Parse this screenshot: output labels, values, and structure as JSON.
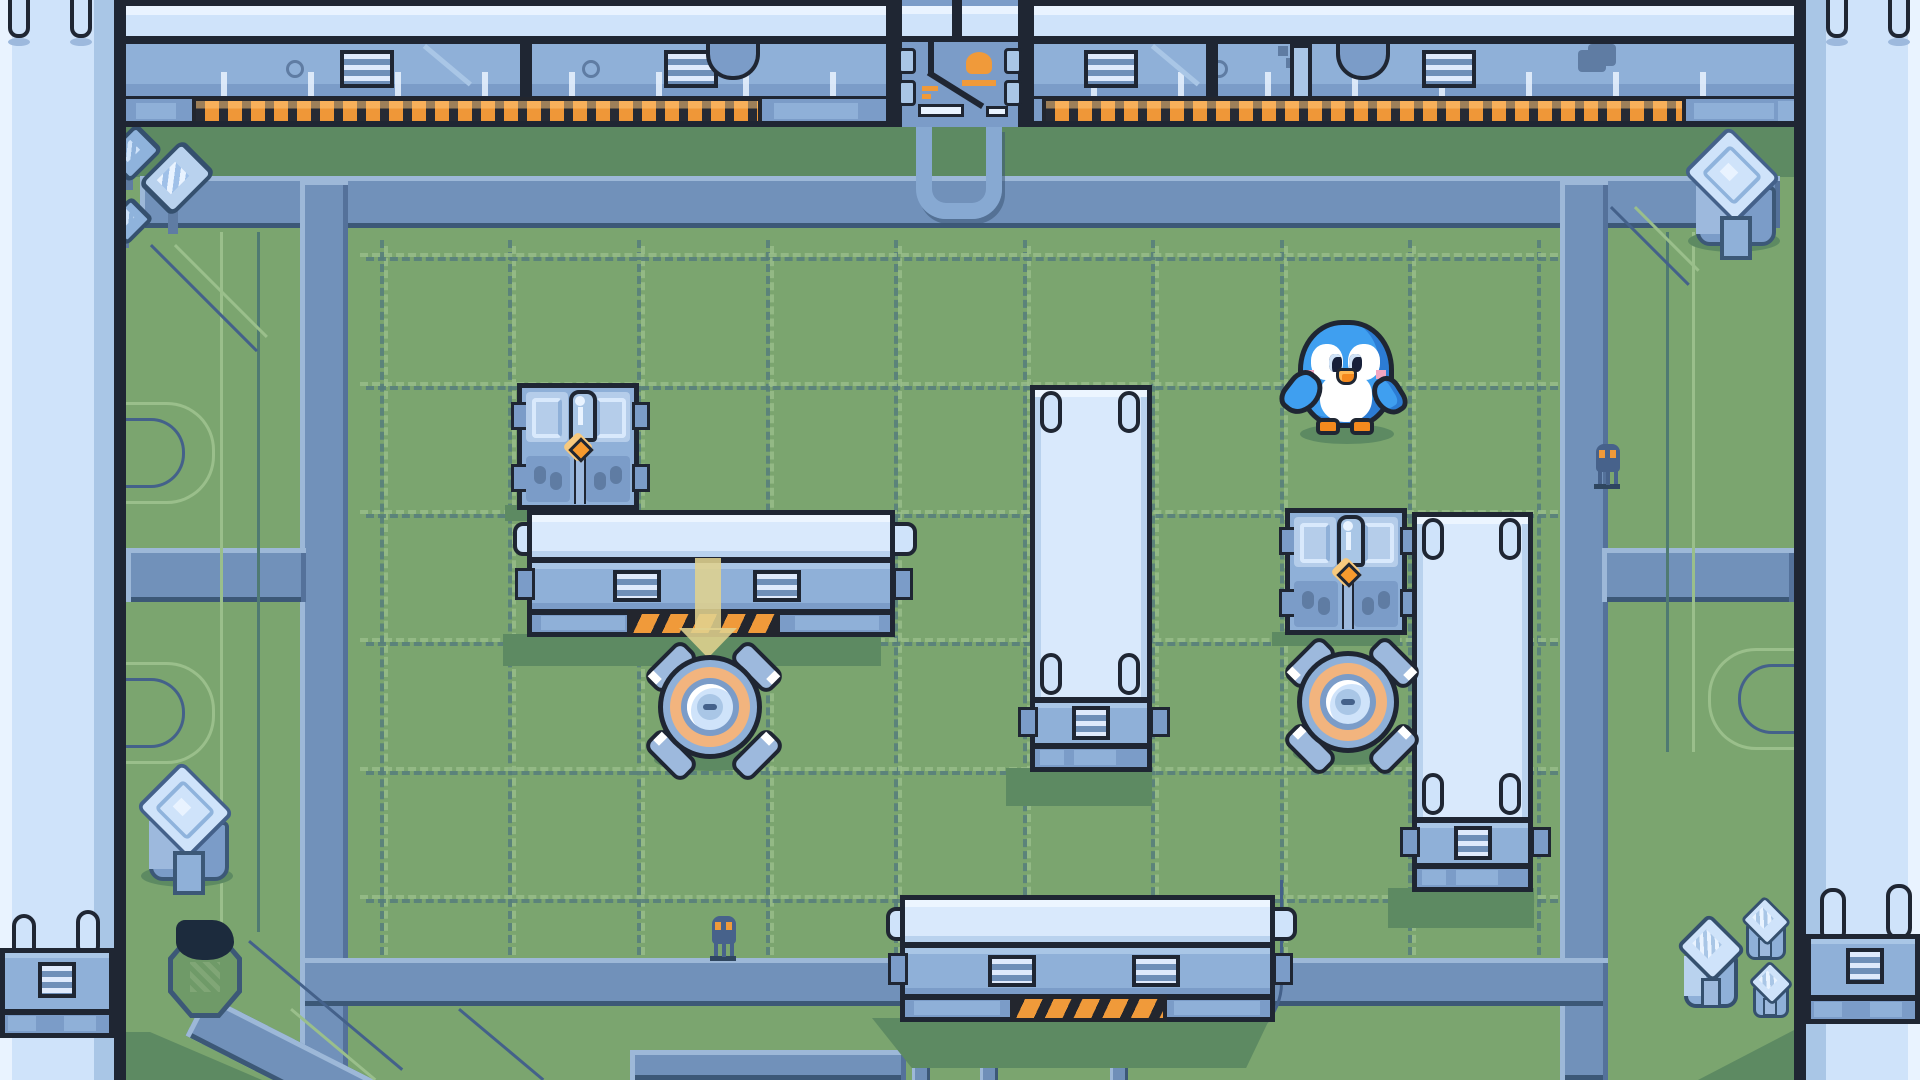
{
  "scene": {
    "description": "top-down pixel-art block-pushing puzzle level",
    "room": "green field bordered by metal walls and blue conduit paths",
    "tile_size_px": 128
  },
  "palette": {
    "ink": "#1f2633",
    "grass": "#7ba56f",
    "grass-dark": "#5d8a62",
    "grid-light": "#9abf8b",
    "grid-dark": "#567e7c",
    "pipe": "#7191ba",
    "pipe-light": "#9db8d8",
    "pipe-dark": "#3c5877",
    "wall-pale": "#cfe3fa",
    "wall-paler": "#e9f3ff",
    "wall-mid": "#a9c6e6",
    "metal": "#8fb0d8",
    "metal-dark": "#7b9cc8",
    "metal-darker": "#5f7ca3",
    "face": "#d9e9fc",
    "orange": "#f09a3a",
    "orange-light": "#ffc577",
    "hazard-dark": "#23262e",
    "gem": "#f79a2e",
    "btn-ring": "#f2b47e",
    "peng-blue": "#3f9ff0",
    "peng-dark": "#2c7cd4",
    "pink": "#f2a6c2",
    "beak": "#f5891d",
    "beak-light": "#ffb954",
    "critter": "#47628b"
  },
  "entities": [
    {
      "name": "player-penguin",
      "kind": "player",
      "x": 1292,
      "y": 318,
      "w": 110,
      "h": 126
    },
    {
      "name": "top-gate",
      "kind": "door",
      "x": 886,
      "y": 0,
      "w": 148,
      "h": 127
    },
    {
      "name": "carved-block-left",
      "kind": "pushable-block",
      "x": 517,
      "y": 383,
      "w": 122,
      "h": 127
    },
    {
      "name": "carved-block-right",
      "kind": "pushable-block",
      "x": 1285,
      "y": 508,
      "w": 122,
      "h": 127
    },
    {
      "name": "crate-horizontal-upper",
      "kind": "sliding-block",
      "x": 527,
      "y": 510,
      "w": 368,
      "h": 127
    },
    {
      "name": "crate-horizontal-lower",
      "kind": "sliding-block",
      "x": 900,
      "y": 895,
      "w": 375,
      "h": 127
    },
    {
      "name": "crate-vertical-center",
      "kind": "sliding-block",
      "x": 1030,
      "y": 385,
      "w": 122,
      "h": 387
    },
    {
      "name": "crate-vertical-right",
      "kind": "sliding-block",
      "x": 1412,
      "y": 512,
      "w": 121,
      "h": 380
    },
    {
      "name": "pressure-button-left",
      "kind": "floor-button",
      "x": 648,
      "y": 645,
      "w": 124,
      "h": 130
    },
    {
      "name": "pressure-button-right",
      "kind": "floor-button",
      "x": 1288,
      "y": 642,
      "w": 120,
      "h": 126
    },
    {
      "name": "down-arrow-indicator",
      "kind": "hint",
      "x": 679,
      "y": 560,
      "w": 58,
      "h": 86
    },
    {
      "name": "pit-hole",
      "kind": "hazard",
      "x": 168,
      "y": 932,
      "w": 74,
      "h": 86
    },
    {
      "name": "pedestal-top-right",
      "kind": "decoration",
      "x": 1682,
      "y": 130,
      "w": 100,
      "h": 128
    },
    {
      "name": "pedestal-bottom-left",
      "kind": "decoration",
      "x": 135,
      "y": 765,
      "w": 100,
      "h": 128
    },
    {
      "name": "crystal-top-left-small",
      "kind": "decoration",
      "x": 108,
      "y": 128,
      "w": 42,
      "h": 66
    },
    {
      "name": "crystal-top-left-large",
      "kind": "decoration",
      "x": 146,
      "y": 144,
      "w": 54,
      "h": 96
    },
    {
      "name": "crystal-top-left-tiny",
      "kind": "decoration",
      "x": 108,
      "y": 200,
      "w": 34,
      "h": 52
    },
    {
      "name": "crystal-cube-br-1",
      "kind": "decoration",
      "x": 1676,
      "y": 916,
      "w": 62,
      "h": 96
    },
    {
      "name": "crystal-cube-br-2",
      "kind": "decoration",
      "x": 1740,
      "y": 898,
      "w": 46,
      "h": 62
    },
    {
      "name": "crystal-cube-br-3",
      "kind": "decoration",
      "x": 1748,
      "y": 962,
      "w": 40,
      "h": 56
    },
    {
      "name": "critter-right-pipe",
      "kind": "npc",
      "x": 1588,
      "y": 438,
      "w": 40,
      "h": 54
    },
    {
      "name": "critter-bottom",
      "kind": "npc",
      "x": 704,
      "y": 910,
      "w": 40,
      "h": 54
    }
  ]
}
